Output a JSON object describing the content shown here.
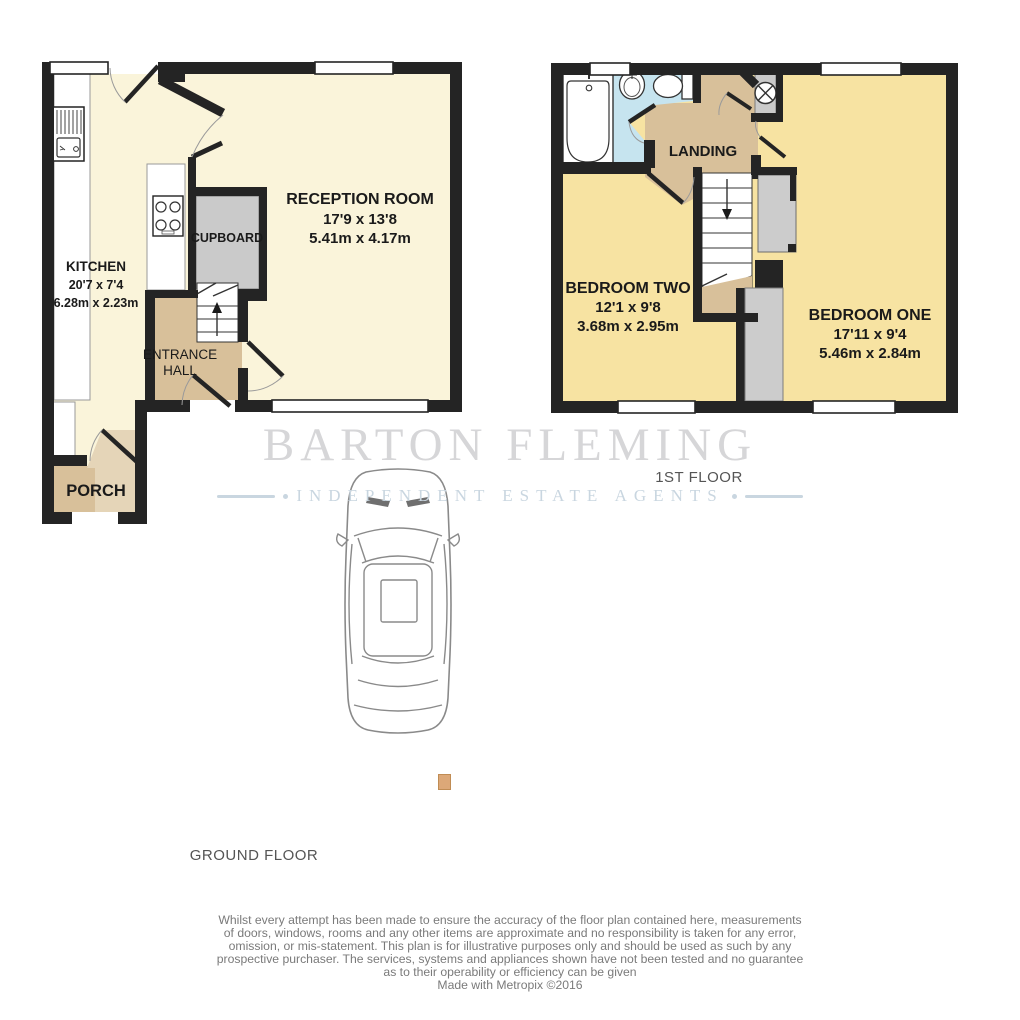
{
  "brand": {
    "name": "BARTON FLEMING",
    "tagline": "INDEPENDENT ESTATE AGENTS"
  },
  "floor_plan": {
    "ground": {
      "label": "GROUND FLOOR",
      "rooms": {
        "kitchen": {
          "name": "KITCHEN",
          "imperial": "20'7 x 7'4",
          "metric": "6.28m x 2.23m"
        },
        "reception": {
          "name": "RECEPTION ROOM",
          "imperial": "17'9 x 13'8",
          "metric": "5.41m x 4.17m"
        },
        "cupboard": {
          "name": "CUPBOARD"
        },
        "entrance_hall": {
          "line1": "ENTRANCE",
          "line2": "HALL"
        },
        "porch": {
          "name": "PORCH"
        }
      }
    },
    "first": {
      "label": "1ST FLOOR",
      "rooms": {
        "landing": {
          "name": "LANDING"
        },
        "bedroom_two": {
          "name": "BEDROOM TWO",
          "imperial": "12'1 x 9'8",
          "metric": "3.68m x 2.95m"
        },
        "bedroom_one": {
          "name": "BEDROOM ONE",
          "imperial": "17'11 x 9'4",
          "metric": "5.46m x 2.84m"
        }
      }
    }
  },
  "footer": {
    "disclaimer_lines": [
      "Whilst every attempt has been made to ensure the accuracy of the floor plan contained here, measurements",
      "of doors, windows, rooms and any other items are approximate and no responsibility is taken for any error,",
      "omission, or mis-statement. This plan is for illustrative purposes only and should be used as such by any",
      "prospective purchaser. The services, systems and appliances shown have not been tested and no guarantee",
      "as to their operability or efficiency can be given"
    ],
    "credit": "Made with Metropix ©2016"
  },
  "colors": {
    "wall": "#242424",
    "ground_floor_fill": "#FAF4DA",
    "bedroom_fill": "#F7E3A2",
    "hall_tan": "#D8C09A",
    "tan_light": "#E5D5B8",
    "bathroom_blue": "#C6E4EF",
    "unit_gray": "#CACACA",
    "watermark_gray": "#D6D6D8",
    "watermark_blue": "#C9D6E0"
  }
}
